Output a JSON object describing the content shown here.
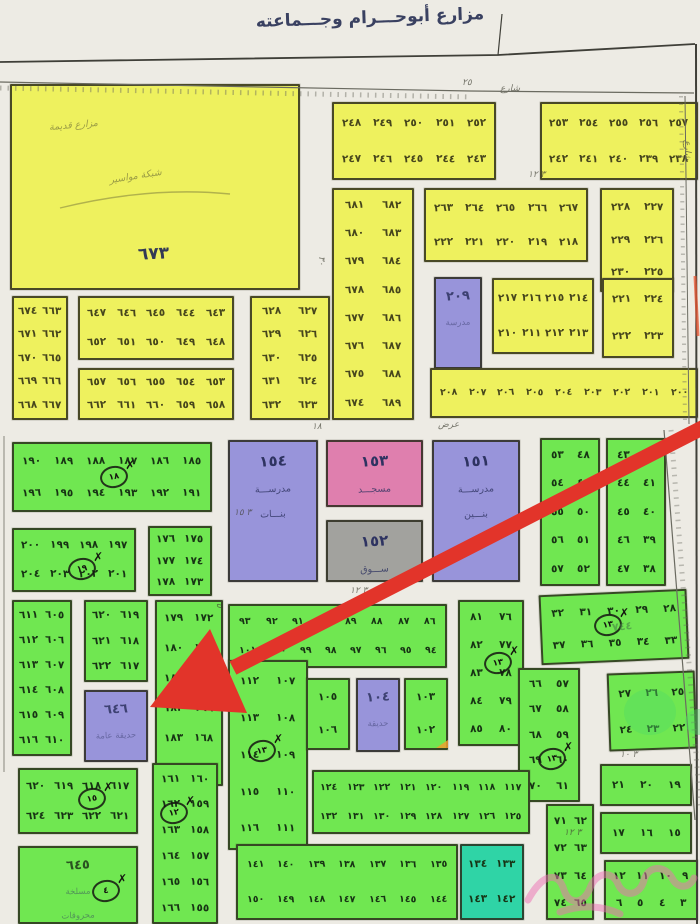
{
  "title": "مزارع أبوحـــرام وجـــماعته",
  "palette": {
    "yellow": "#eef15e",
    "green": "#70e751",
    "purple": "#9894da",
    "pink": "#df7fae",
    "gray": "#a2a29e",
    "teal": "#2fd4a6",
    "arrow": "#e2342a",
    "scribble_pink": "#ee6fb3",
    "highlight_green": "rgba(80,220,100,0.42)"
  },
  "annotations": {
    "green_scribble": "٧٤٤"
  },
  "blocks": [
    {
      "name": "farm-673",
      "fill": "yellow",
      "cls": "farm",
      "x": 10,
      "y": 84,
      "w": 290,
      "h": 206,
      "label": "٦٧٣",
      "notes": [
        "مزارع قديمة",
        "شبكة مواسير"
      ]
    },
    {
      "name": "yellow-block-248-252",
      "fill": "yellow",
      "x": 332,
      "y": 102,
      "w": 164,
      "h": 78,
      "rows": [
        [
          "٢٤٨",
          "٢٤٩",
          "٢٥٠",
          "٢٥١",
          "٢٥٢"
        ],
        [
          "٢٤٧",
          "٢٤٦",
          "٢٤٥",
          "٢٤٤",
          "٢٤٣"
        ]
      ]
    },
    {
      "name": "yellow-block-253-257",
      "fill": "yellow",
      "x": 540,
      "y": 102,
      "w": 158,
      "h": 78,
      "rows": [
        [
          "٢٥٣",
          "٢٥٤",
          "٢٥٥",
          "٢٥٦",
          "٢٥٧"
        ],
        [
          "٢٤٢",
          "٢٤١",
          "٢٤٠",
          "٢٣٩",
          "٢٣٨"
        ]
      ]
    },
    {
      "name": "yellow-block-674-689",
      "fill": "yellow",
      "x": 332,
      "y": 188,
      "w": 82,
      "h": 232,
      "rows": [
        [
          "٦٨١",
          "٦٨٢"
        ],
        [
          "٦٨٠",
          "٦٨٣"
        ],
        [
          "٦٧٩",
          "٦٨٤"
        ],
        [
          "٦٧٨",
          "٦٨٥"
        ],
        [
          "٦٧٧",
          "٦٨٦"
        ],
        [
          "٦٧٦",
          "٦٨٧"
        ],
        [
          "٦٧٥",
          "٦٨٨"
        ],
        [
          "٦٧٤",
          "٦٨٩"
        ]
      ]
    },
    {
      "name": "yellow-block-263-267",
      "fill": "yellow",
      "x": 424,
      "y": 188,
      "w": 164,
      "h": 74,
      "rows": [
        [
          "٢٦٣",
          "٢٦٤",
          "٢٦٥",
          "٢٦٦",
          "٢٦٧"
        ],
        [
          "٢٢٢",
          "٢٢١",
          "٢٢٠",
          "٢١٩",
          "٢١٨"
        ]
      ]
    },
    {
      "name": "yellow-block-225-230",
      "fill": "yellow",
      "x": 600,
      "y": 188,
      "w": 74,
      "h": 104,
      "rows": [
        [
          "٢٢٨",
          "٢٢٧"
        ],
        [
          "٢٢٩",
          "٢٢٦"
        ],
        [
          "٢٣٠",
          "٢٢٥"
        ]
      ]
    },
    {
      "name": "school-209",
      "fill": "purple",
      "cls": "fac faint",
      "x": 434,
      "y": 277,
      "w": 48,
      "h": 92,
      "label": "٢٠٩",
      "subs": [
        "مدرسة"
      ]
    },
    {
      "name": "yellow-block-210-217",
      "fill": "yellow",
      "x": 492,
      "y": 278,
      "w": 102,
      "h": 76,
      "rows": [
        [
          "٢١٧",
          "٢١٦",
          "٢١٥",
          "٢١٤"
        ],
        [
          "٢١٠",
          "٢١١",
          "٢١٢",
          "٢١٣"
        ]
      ]
    },
    {
      "name": "yellow-block-221-224",
      "fill": "yellow",
      "x": 602,
      "y": 278,
      "w": 72,
      "h": 80,
      "rows": [
        [
          "٢٢١",
          "٢٢٤"
        ],
        [
          "٢٢٢",
          "٢٢٣"
        ]
      ]
    },
    {
      "name": "yellow-strip-200-208",
      "fill": "yellow",
      "cls": "dense",
      "x": 430,
      "y": 368,
      "w": 268,
      "h": 50,
      "rows": [
        [
          "٢٠٨",
          "٢٠٧",
          "٢٠٦",
          "٢٠٥",
          "٢٠٤",
          "٢٠٣",
          "٢٠٢",
          "٢٠١",
          "٢٠٠"
        ]
      ]
    },
    {
      "name": "yellow-block-663-674",
      "fill": "yellow",
      "x": 12,
      "y": 296,
      "w": 56,
      "h": 124,
      "rows": [
        [
          "٦٧٤",
          "٦٦٣"
        ],
        [
          "٦٧١",
          "٦٦٢"
        ],
        [
          "٦٧٠",
          "٦٦٥"
        ],
        [
          "٦٦٩",
          "٦٦٦"
        ],
        [
          "٦٦٨",
          "٦٦٧"
        ]
      ]
    },
    {
      "name": "yellow-block-643-652",
      "fill": "yellow",
      "x": 78,
      "y": 296,
      "w": 156,
      "h": 64,
      "rows": [
        [
          "٦٤٧",
          "٦٤٦",
          "٦٤٥",
          "٦٤٤",
          "٦٤٣"
        ],
        [
          "٦٥٢",
          "٦٥١",
          "٦٥٠",
          "٦٤٩",
          "٦٤٨"
        ]
      ]
    },
    {
      "name": "yellow-block-653-662",
      "fill": "yellow",
      "x": 78,
      "y": 368,
      "w": 156,
      "h": 52,
      "rows": [
        [
          "٦٥٧",
          "٦٥٦",
          "٦٥٥",
          "٦٥٤",
          "٦٥٣"
        ],
        [
          "٦٦٢",
          "٦٦١",
          "٦٦٠",
          "٦٥٩",
          "٦٥٨"
        ]
      ]
    },
    {
      "name": "yellow-block-623-632",
      "fill": "yellow",
      "x": 250,
      "y": 296,
      "w": 80,
      "h": 124,
      "rows": [
        [
          "٦٢٨",
          "٦٢٧"
        ],
        [
          "٦٢٩",
          "٦٢٦"
        ],
        [
          "٦٣٠",
          "٦٢٥"
        ],
        [
          "٦٣١",
          "٦٢٤"
        ],
        [
          "٦٣٢",
          "٦٢٣"
        ]
      ]
    },
    {
      "name": "green-block-185-196",
      "fill": "green",
      "x": 12,
      "y": 442,
      "w": 200,
      "h": 70,
      "rows": [
        [
          "١٩٠",
          "١٨٩",
          "١٨٨",
          "١٨٧",
          "١٨٦",
          "١٨٥"
        ],
        [
          "١٩٦",
          "١٩٥",
          "١٩٤",
          "١٩٣",
          "١٩٢",
          "١٩١"
        ]
      ]
    },
    {
      "name": "green-block-197-204",
      "fill": "green",
      "x": 12,
      "y": 528,
      "w": 124,
      "h": 64,
      "rows": [
        [
          "٢٠٠",
          "١٩٩",
          "١٩٨",
          "١٩٧"
        ],
        [
          "٢٠٤",
          "٢٠٣",
          "٢٠٢",
          "٢٠١"
        ]
      ]
    },
    {
      "name": "green-block-173-178",
      "fill": "green",
      "x": 148,
      "y": 526,
      "w": 64,
      "h": 70,
      "rows": [
        [
          "١٧٦",
          "١٧٥"
        ],
        [
          "١٧٧",
          "١٧٤"
        ],
        [
          "١٧٨",
          "١٧٣"
        ]
      ]
    },
    {
      "name": "green-block-167-184-arrow-target",
      "fill": "green",
      "x": 155,
      "y": 600,
      "w": 68,
      "h": 186,
      "rows": [
        [
          "١٧٩",
          "١٧٢"
        ],
        [
          "١٨٠",
          "١٧١"
        ],
        [
          "١٨١",
          "١٧٠"
        ],
        [
          "١٨٢",
          "١٦٩"
        ],
        [
          "١٨٣",
          "١٦٨"
        ],
        [
          "١٨٤",
          "١٦٧"
        ]
      ]
    },
    {
      "name": "green-block-155-166",
      "fill": "green",
      "x": 152,
      "y": 763,
      "w": 66,
      "h": 161,
      "rows": [
        [
          "١٦١",
          "١٦٠"
        ],
        [
          "١٦٢",
          "١٥٩"
        ],
        [
          "١٦٣",
          "١٥٨"
        ],
        [
          "١٦٤",
          "١٥٧"
        ],
        [
          "١٦٥",
          "١٥٦"
        ],
        [
          "١٦٦",
          "١٥٥"
        ]
      ]
    },
    {
      "name": "girls-school-154",
      "fill": "purple",
      "cls": "fac",
      "x": 228,
      "y": 440,
      "w": 90,
      "h": 142,
      "label": "١٥٤",
      "subs": [
        "مدرســـة",
        "بنـــات"
      ]
    },
    {
      "name": "mosque-153",
      "fill": "pink",
      "cls": "fac",
      "x": 326,
      "y": 440,
      "w": 97,
      "h": 67,
      "label": "١٥٣",
      "subs": [
        "مسجـــد"
      ]
    },
    {
      "name": "market-152",
      "fill": "gray",
      "cls": "fac",
      "x": 326,
      "y": 520,
      "w": 97,
      "h": 62,
      "label": "١٥٢",
      "subs": [
        "ســـوق"
      ]
    },
    {
      "name": "boys-school-151",
      "fill": "purple",
      "cls": "fac",
      "x": 432,
      "y": 440,
      "w": 88,
      "h": 142,
      "label": "١٥١",
      "subs": [
        "مدرســـة",
        "بنـــين"
      ]
    },
    {
      "name": "green-strip-86-101",
      "fill": "green",
      "cls": "dense",
      "x": 228,
      "y": 604,
      "w": 219,
      "h": 64,
      "rows": [
        [
          "٩٣",
          "٩٢",
          "٩١",
          "٩٠",
          "٨٩",
          "٨٨",
          "٨٧",
          "٨٦"
        ],
        [
          "١٠١",
          "١٠٠",
          "٩٩",
          "٩٨",
          "٩٧",
          "٩٦",
          "٩٥",
          "٩٤"
        ]
      ]
    },
    {
      "name": "green-block-76-85",
      "fill": "green",
      "x": 458,
      "y": 600,
      "w": 66,
      "h": 146,
      "rows": [
        [
          "٨١",
          "٧٦"
        ],
        [
          "٨٢",
          "٧٧"
        ],
        [
          "٨٣",
          "٧٨"
        ],
        [
          "٨٤",
          "٧٩"
        ],
        [
          "٨٥",
          "٨٠"
        ]
      ]
    },
    {
      "name": "green-block-28-37",
      "fill": "green",
      "rot": -2.5,
      "x": 540,
      "y": 592,
      "w": 148,
      "h": 70,
      "rows": [
        [
          "٣٢",
          "٣١",
          "٣٠",
          "٢٩",
          "٢٨"
        ],
        [
          "٣٧",
          "٣٦",
          "٣٥",
          "٣٤",
          "٣٣"
        ]
      ]
    },
    {
      "name": "green-block-48-57",
      "fill": "green",
      "x": 540,
      "y": 438,
      "w": 60,
      "h": 148,
      "rows": [
        [
          "٥٣",
          "٤٨"
        ],
        [
          "٥٤",
          "٤٩"
        ],
        [
          "٥٥",
          "٥٠"
        ],
        [
          "٥٦",
          "٥١"
        ],
        [
          "٥٧",
          "٥٢"
        ]
      ]
    },
    {
      "name": "green-block-38-47",
      "fill": "green",
      "x": 606,
      "y": 438,
      "w": 60,
      "h": 148,
      "rows": [
        [
          "٤٣",
          "٤٢"
        ],
        [
          "٤٤",
          "٤١"
        ],
        [
          "٤٥",
          "٤٠"
        ],
        [
          "٤٦",
          "٣٩"
        ],
        [
          "٤٧",
          "٣٨"
        ]
      ]
    },
    {
      "name": "green-block-57-70",
      "fill": "green",
      "x": 518,
      "y": 668,
      "w": 62,
      "h": 134,
      "rows": [
        [
          "٦٦",
          "٥٧"
        ],
        [
          "٦٧",
          "٥٨"
        ],
        [
          "٦٨",
          "٥٩"
        ],
        [
          "٦٩",
          "٦٠"
        ],
        [
          "٧٠",
          "٦١"
        ]
      ]
    },
    {
      "name": "green-block-22-27",
      "fill": "green",
      "rot": -2,
      "x": 608,
      "y": 672,
      "w": 88,
      "h": 78,
      "rows": [
        [
          "٢٧",
          "٢٦",
          "٢٥"
        ],
        [
          "٢٤",
          "٢٣",
          "٢٢"
        ]
      ]
    },
    {
      "name": "green-block-19-21",
      "fill": "green",
      "x": 600,
      "y": 764,
      "w": 92,
      "h": 42,
      "rows": [
        [
          "٢١",
          "٢٠",
          "١٩"
        ]
      ]
    },
    {
      "name": "green-block-15-17",
      "fill": "green",
      "x": 600,
      "y": 812,
      "w": 92,
      "h": 42,
      "rows": [
        [
          "١٧",
          "١٦",
          "١٥"
        ]
      ]
    },
    {
      "name": "green-block-3-12",
      "fill": "green",
      "x": 604,
      "y": 860,
      "w": 94,
      "h": 60,
      "rows": [
        [
          "١٢",
          "١١",
          "١٠",
          "٩"
        ],
        [
          "٦",
          "٥",
          "٤",
          "٣"
        ]
      ]
    },
    {
      "name": "green-block-605-616",
      "fill": "green",
      "x": 12,
      "y": 600,
      "w": 60,
      "h": 156,
      "rows": [
        [
          "٦١١",
          "٦٠٥"
        ],
        [
          "٦١٢",
          "٦٠٦"
        ],
        [
          "٦١٣",
          "٦٠٧"
        ],
        [
          "٦١٤",
          "٦٠٨"
        ],
        [
          "٦١٥",
          "٦٠٩"
        ],
        [
          "٦١٦",
          "٦١٠"
        ]
      ]
    },
    {
      "name": "green-block-617-622",
      "fill": "green",
      "x": 84,
      "y": 600,
      "w": 64,
      "h": 82,
      "rows": [
        [
          "٦٢٠",
          "٦١٩"
        ],
        [
          "٦٢١",
          "٦١٨"
        ],
        [
          "٦٢٢",
          "٦١٧"
        ]
      ]
    },
    {
      "name": "garden-646",
      "fill": "purple",
      "cls": "fac faint",
      "x": 84,
      "y": 690,
      "w": 64,
      "h": 72,
      "label": "٦٤٦",
      "subs": [
        "حديقة عامة"
      ]
    },
    {
      "name": "green-block-107-116",
      "fill": "green",
      "x": 228,
      "y": 660,
      "w": 80,
      "h": 190,
      "rows": [
        [
          "١١٢",
          "١٠٧"
        ],
        [
          "١١٣",
          "١٠٨"
        ],
        [
          "١١٤",
          "١٠٩"
        ],
        [
          "١١٥",
          "١١٠"
        ],
        [
          "١١٦",
          "١١١"
        ]
      ]
    },
    {
      "name": "green-block-105-106",
      "fill": "green",
      "x": 306,
      "y": 678,
      "w": 44,
      "h": 72,
      "rows": [
        [
          "١٠٥"
        ],
        [
          "١٠٦"
        ]
      ]
    },
    {
      "name": "garden-104",
      "fill": "purple",
      "cls": "fac faint",
      "x": 356,
      "y": 678,
      "w": 44,
      "h": 74,
      "label": "١٠٤",
      "subs": [
        "حديقة"
      ]
    },
    {
      "name": "green-block-102-103",
      "fill": "green",
      "x": 404,
      "y": 678,
      "w": 44,
      "h": 72,
      "rows": [
        [
          "١٠٣"
        ],
        [
          "١٠٢"
        ]
      ]
    },
    {
      "name": "green-block-62-74",
      "fill": "green",
      "x": 546,
      "y": 804,
      "w": 48,
      "h": 116,
      "rows": [
        [
          "٧١",
          "٦٢"
        ],
        [
          "٧٢",
          "٦٣"
        ],
        [
          "٧٣",
          "٦٤"
        ],
        [
          "٧٤",
          "٦٥"
        ]
      ]
    },
    {
      "name": "green-strip-117-132",
      "fill": "green",
      "cls": "dense",
      "x": 312,
      "y": 770,
      "w": 218,
      "h": 64,
      "rows": [
        [
          "١٢٤",
          "١٢٣",
          "١٢٢",
          "١٢١",
          "١٢٠",
          "١١٩",
          "١١٨",
          "١١٧"
        ],
        [
          "١٣٢",
          "١٣١",
          "١٣٠",
          "١٢٩",
          "١٢٨",
          "١٢٧",
          "١٢٦",
          "١٢٥"
        ]
      ]
    },
    {
      "name": "green-strip-135-150",
      "fill": "green",
      "cls": "dense",
      "x": 236,
      "y": 844,
      "w": 222,
      "h": 76,
      "rows": [
        [
          "١٤١",
          "١٤٠",
          "١٣٩",
          "١٣٨",
          "١٣٧",
          "١٣٦",
          "١٣٥"
        ],
        [
          "١٥٠",
          "١٤٩",
          "١٤٨",
          "١٤٧",
          "١٤٦",
          "١٤٥",
          "١٤٤"
        ]
      ]
    },
    {
      "name": "teal-block-133-143",
      "fill": "teal",
      "x": 460,
      "y": 844,
      "w": 64,
      "h": 76,
      "rows": [
        [
          "١٣٤",
          "١٣٣"
        ],
        [
          "١٤٣",
          "١٤٢"
        ]
      ]
    },
    {
      "name": "green-block-617-624-south",
      "fill": "green",
      "x": 18,
      "y": 768,
      "w": 120,
      "h": 66,
      "rows": [
        [
          "٦٢٠",
          "٦١٩",
          "٦١٨",
          "٦١٧"
        ],
        [
          "٦٢٤",
          "٦٢٣",
          "٦٢٢",
          "٦٢١"
        ]
      ]
    },
    {
      "name": "slaughterhouse-645",
      "fill": "green",
      "cls": "fac faint gblock31",
      "x": 18,
      "y": 846,
      "w": 120,
      "h": 78,
      "label": "٦٤٥",
      "subs": [
        "مسلخة",
        "محروقات"
      ]
    }
  ],
  "markers": [
    {
      "x": 100,
      "y": 466,
      "num": "١٨"
    },
    {
      "x": 68,
      "y": 558,
      "num": "١٩"
    },
    {
      "x": 594,
      "y": 614,
      "num": "١٣"
    },
    {
      "x": 484,
      "y": 652,
      "num": "١٣"
    },
    {
      "x": 248,
      "y": 740,
      "num": "١٣"
    },
    {
      "x": 538,
      "y": 748,
      "num": "١٣"
    },
    {
      "x": 160,
      "y": 802,
      "num": "١٢"
    },
    {
      "x": 78,
      "y": 788,
      "num": "١٥"
    },
    {
      "x": 92,
      "y": 880,
      "num": "٤"
    }
  ],
  "street_labels": [
    {
      "t": "٢٥",
      "x": 462,
      "y": 78
    },
    {
      "t": "شارع",
      "x": 500,
      "y": 84
    },
    {
      "t": "٣ ١٢",
      "x": 528,
      "y": 170
    },
    {
      "t": "٣٠",
      "x": 316,
      "y": 256,
      "v": true
    },
    {
      "t": "١٨",
      "x": 312,
      "y": 422
    },
    {
      "t": "عرض",
      "x": 438,
      "y": 420
    },
    {
      "t": "٣ ١٥",
      "x": 234,
      "y": 508
    },
    {
      "t": "٣ ١٢",
      "x": 350,
      "y": 586
    },
    {
      "t": "١٥",
      "x": 214,
      "y": 598,
      "v": true
    },
    {
      "t": "٣ ١٠",
      "x": 620,
      "y": 750
    },
    {
      "t": "٣ ١٢",
      "x": 564,
      "y": 828
    },
    {
      "t": "شارع",
      "x": 682,
      "y": 140,
      "v": true
    }
  ]
}
